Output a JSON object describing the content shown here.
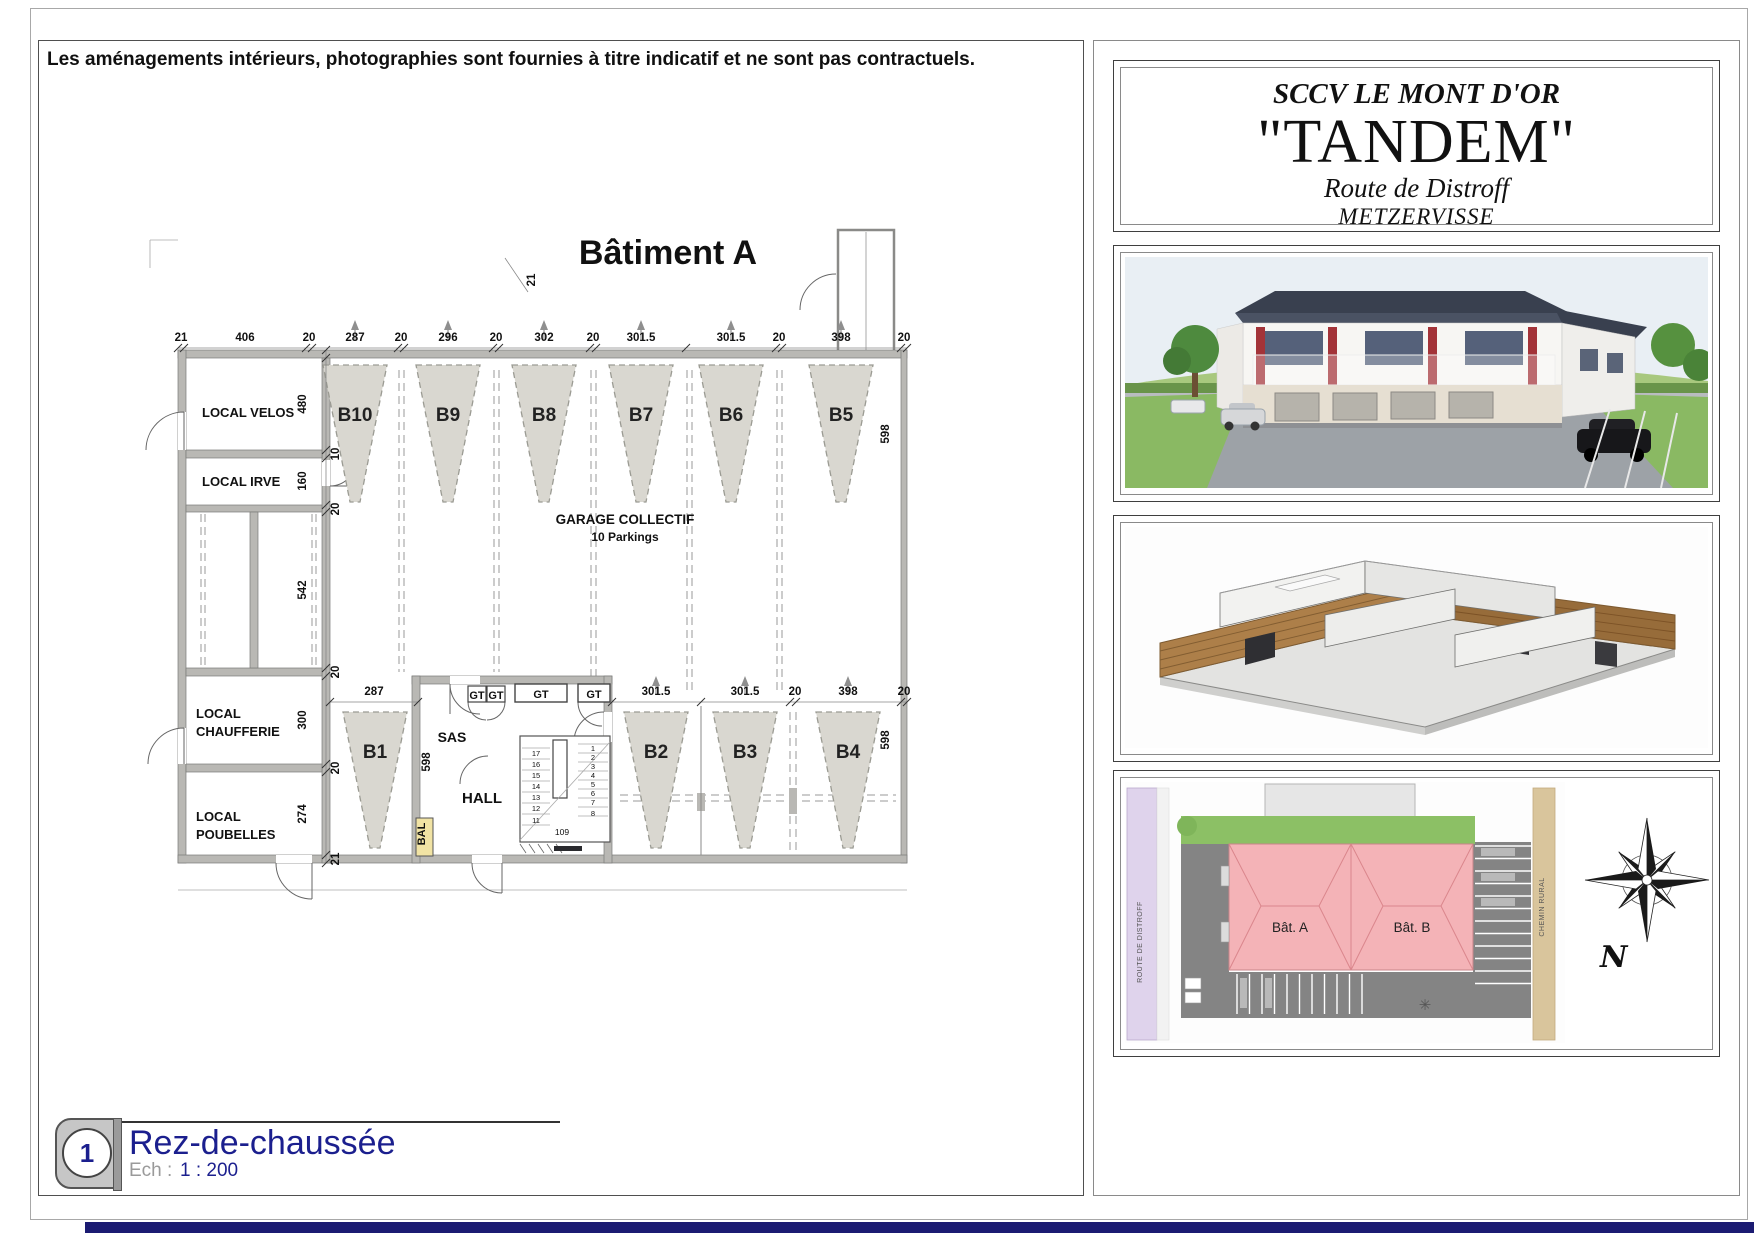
{
  "page": {
    "disclaimer": "Les aménagements intérieurs, photographies sont fournies à titre indicatif et ne sont pas contractuels."
  },
  "title_block": {
    "company": "SCCV LE MONT D'OR",
    "project": "\"TANDEM\"",
    "street": "Route de Distroff",
    "city": "METZERVISSE"
  },
  "plan": {
    "title": "Bâtiment A",
    "garage": {
      "label": "GARAGE COLLECTIF",
      "sublabel": "10 Parkings"
    },
    "rooms": {
      "velos": "LOCAL VELOS",
      "irve": "LOCAL IRVE",
      "chaufferie": [
        "LOCAL",
        "CHAUFFERIE"
      ],
      "poubelles": [
        "LOCAL",
        "POUBELLES"
      ],
      "sas": "SAS",
      "hall": "HALL",
      "bal": "BAL"
    },
    "parking_top": [
      "B10",
      "B9",
      "B8",
      "B7",
      "B6",
      "B5"
    ],
    "parking_bottom": [
      "B1",
      "B2",
      "B3",
      "B4"
    ],
    "gt": [
      "GT",
      "GT",
      "GT",
      "GT"
    ],
    "dims_top": [
      "21",
      "406",
      "20",
      "287",
      "20",
      "296",
      "20",
      "302",
      "20",
      "301.5",
      "301.5",
      "20",
      "398",
      "20"
    ],
    "dims_left": [
      "480",
      "10",
      "160",
      "20",
      "542",
      "20",
      "300",
      "20",
      "274",
      "21"
    ],
    "dims_bottom": [
      "287",
      "301.5",
      "301.5",
      "20",
      "398",
      "20"
    ],
    "wall_dim": "21",
    "depth_dim": "598",
    "stairs": {
      "left": [
        "17",
        "16",
        "15",
        "14",
        "13",
        "12",
        "11"
      ],
      "right": [
        "1",
        "2",
        "3",
        "4",
        "5",
        "6",
        "7",
        "8"
      ],
      "dim": "109"
    }
  },
  "site_plan": {
    "building_a": "Bât. A",
    "building_b": "Bât. B",
    "road_left": "ROUTE DE DISTROFF",
    "road_right": "CHEMIN RURAL",
    "north": "N",
    "tree_symbol": "✳"
  },
  "footer": {
    "index": "1",
    "floor": "Rez-de-chaussée",
    "scale_label": "Ech :",
    "scale_value": "1 : 200"
  }
}
